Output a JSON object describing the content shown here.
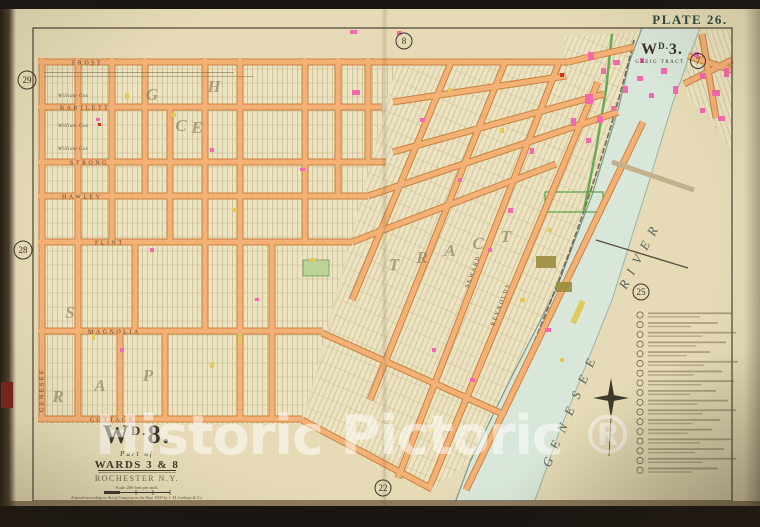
{
  "plate": {
    "label": "PLATE 26."
  },
  "ward3": {
    "w": "W",
    "sup": "D.",
    "num": "3.",
    "tract": "GREIG TRACT"
  },
  "page_refs": {
    "top": "8",
    "top_right": "7",
    "left_upper": "29",
    "left_lower": "28",
    "right": "25",
    "bottom": "22"
  },
  "streets": {
    "horizontal": [
      "FROST",
      "BARTLETT",
      "STRONG",
      "HAWLEY",
      "FLINT",
      "MAGNOLIA",
      "COTTAGE"
    ],
    "vertical": [
      "GENESEE"
    ],
    "diagonal": [
      "SEWARD",
      "REYNOLDS"
    ]
  },
  "owners": {
    "repeat": "William Cox"
  },
  "tract_letters": [
    "G",
    "H",
    "C",
    "E",
    "S",
    "R",
    "A",
    "P",
    "T",
    "R",
    "A",
    "C",
    "T"
  ],
  "river": {
    "word1": "GENESEE",
    "word2": "RIVER"
  },
  "title_block": {
    "w": "W",
    "sup": "D.",
    "num": "8.",
    "part_of": "Part of",
    "wards": "WARDS 3 & 8",
    "city": "ROCHESTER N.Y.",
    "scale": "Scale 200 feet per inch.",
    "copyright": "Entered according to Act of Congress in the Year 1900 by J. M. Lathrop & Co."
  },
  "legend": {
    "note_count": 17
  },
  "watermark": {
    "text": "Historic Pictoric ®"
  },
  "colors": {
    "page": "#e6dbb6",
    "street": "#f3b175",
    "street_edge": "#c9823e",
    "river": "#d9e7da",
    "canal_green": "#55a047",
    "building_pink": "#f468b0",
    "building_yellow": "#e0ca5e",
    "plate_green": "#2b4a3b",
    "watermark_white": "rgba(255,255,255,0.5)"
  }
}
